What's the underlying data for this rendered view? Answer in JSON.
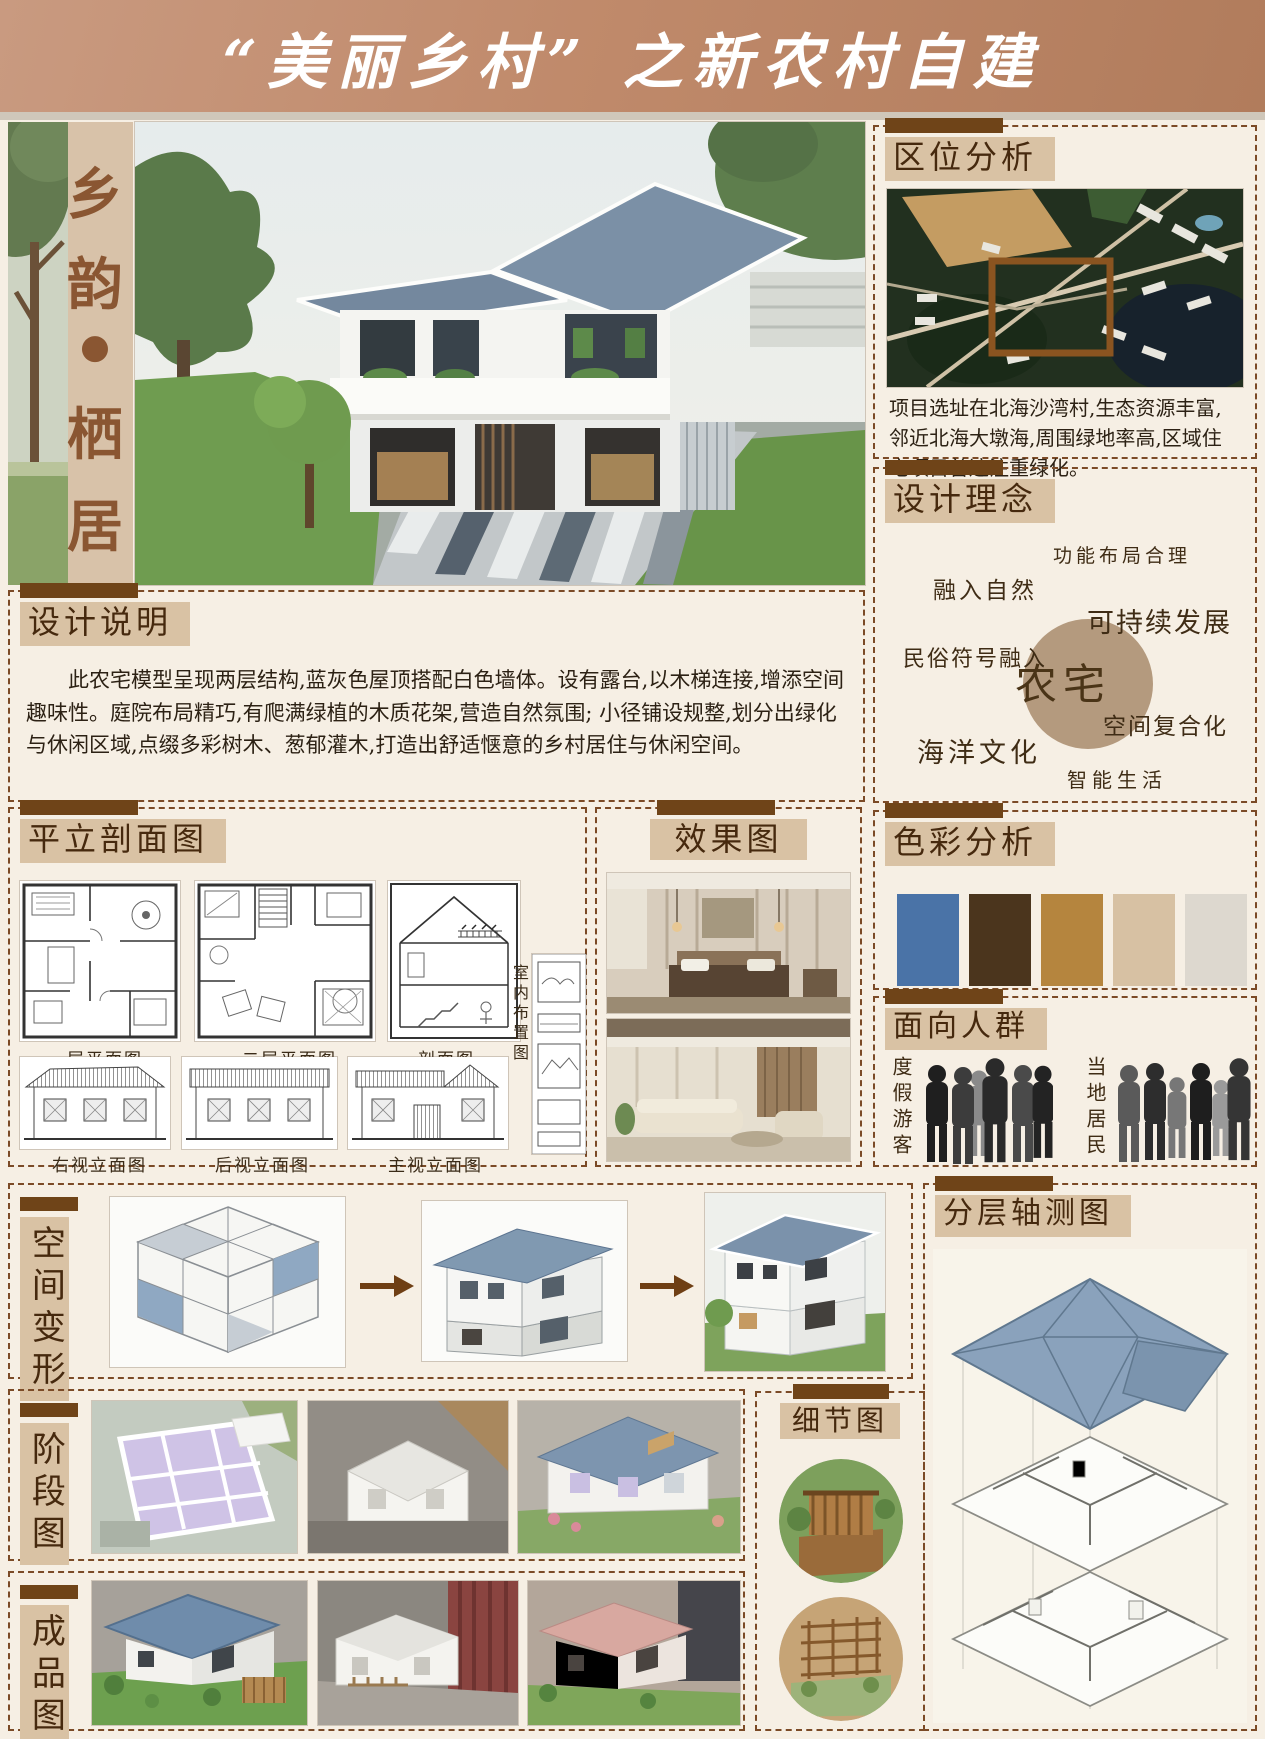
{
  "header": {
    "title": "“美丽乡村” 之新农村自建"
  },
  "side_banner": {
    "chars": [
      "乡",
      "韵",
      "●",
      "栖",
      "居"
    ]
  },
  "sections": {
    "location": {
      "title": "区位分析",
      "text": "项目选址在北海沙湾村,生态资源丰富,邻近北海大墩海,周围绿地率高,区域住宅项目普遍注重绿化。"
    },
    "concept": {
      "title": "设计理念",
      "center": "农宅",
      "keywords": [
        "功能布局合理",
        "融入自然",
        "可持续发展",
        "民俗符号融入",
        "空间复合化",
        "海洋文化",
        "智能生活"
      ]
    },
    "notes": {
      "title": "设计说明",
      "text": "此农宅模型呈现两层结构,蓝灰色屋顶搭配白色墙体。设有露台,以木梯连接,增添空间趣味性。庭院布局精巧,有爬满绿植的木质花架,营造自然氛围; 小径铺设规整,划分出绿化与休闲区域,点缀多彩树木、葱郁灌木,打造出舒适惬意的乡村居住与休闲空间。"
    },
    "drawings": {
      "title": "平立剖面图",
      "labels": [
        "一层平面图",
        "二层平面图",
        "剖面图",
        "右视立面图",
        "后视立面图",
        "主视立面图",
        "室内布置图"
      ]
    },
    "renders": {
      "title": "效果图"
    },
    "colors": {
      "title": "色彩分析",
      "palette": [
        "#4a73a7",
        "#4b351d",
        "#b5853e",
        "#d7c1a3",
        "#ddd8cf"
      ]
    },
    "audience": {
      "title": "面向人群",
      "groups": [
        "度假游客",
        "当地居民"
      ]
    },
    "transform": {
      "title": "空间变形"
    },
    "axon": {
      "title": "分层轴测图"
    },
    "stages": {
      "title": "阶段图"
    },
    "details": {
      "title": "细节图"
    },
    "finished": {
      "title": "成品图"
    }
  }
}
